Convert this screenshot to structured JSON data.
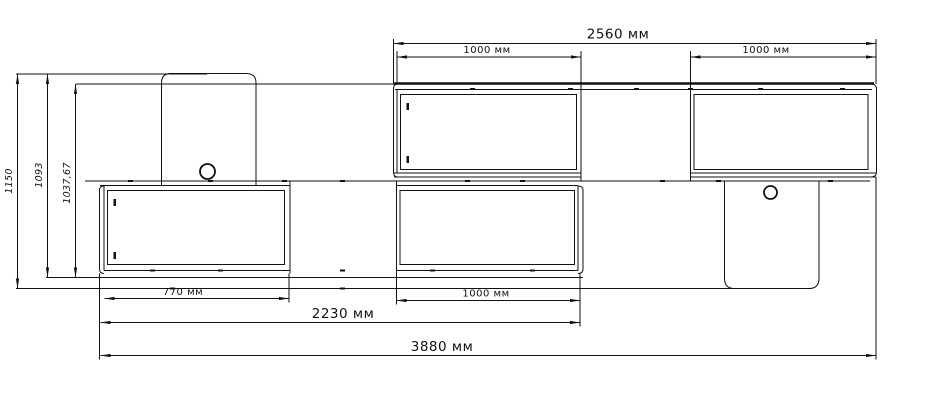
{
  "drawing_units": "мм",
  "dimensions": {
    "top_total": "2560 мм",
    "upper_left_width": "1000 мм",
    "upper_right_width": "1000 мм",
    "lower_left_width": "770 мм",
    "lower_middle_width": "1000 мм",
    "lower_span": "2230 мм",
    "overall_width": "3880 мм",
    "overall_height": "1150",
    "height_to_base": "1093",
    "upper_band_height": "1037,67"
  },
  "colors": {
    "line": "#111111",
    "background": "#ffffff"
  }
}
